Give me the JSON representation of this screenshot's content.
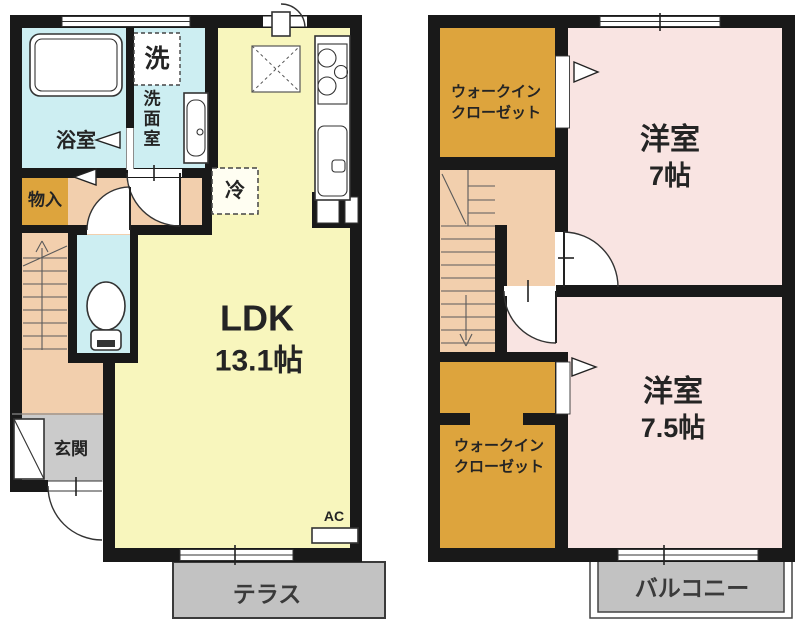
{
  "title": "2-story apartment floor plan",
  "labels": {
    "f1": {
      "bath": "浴室",
      "laundry": "洗",
      "washroom1": "洗",
      "washroom2": "面",
      "washroom3": "室",
      "storage": "物入",
      "fridge": "冷",
      "ldk": "LDK",
      "ldk_size": "13.1帖",
      "entrance": "玄関",
      "terrace": "テラス",
      "ac": "AC"
    },
    "f2": {
      "wic1_line1": "ウォークイン",
      "wic1_line2": "クローゼット",
      "room1": "洋室",
      "room1_size": "7帖",
      "room2": "洋室",
      "room2_size": "7.5帖",
      "wic2_line1": "ウォークイン",
      "wic2_line2": "クローゼット",
      "balcony": "バルコニー"
    }
  },
  "colors": {
    "wall": "#191919",
    "ldk_yellow": "#f8f6bd",
    "wet_cyan": "#cdeef2",
    "hall_peach": "#f2cfad",
    "closet_orange": "#dda43d",
    "bedroom_pink": "#f9e4e2",
    "outdoor_gray": "#c2c2c2",
    "entrance_gray": "#cbcbcb"
  }
}
